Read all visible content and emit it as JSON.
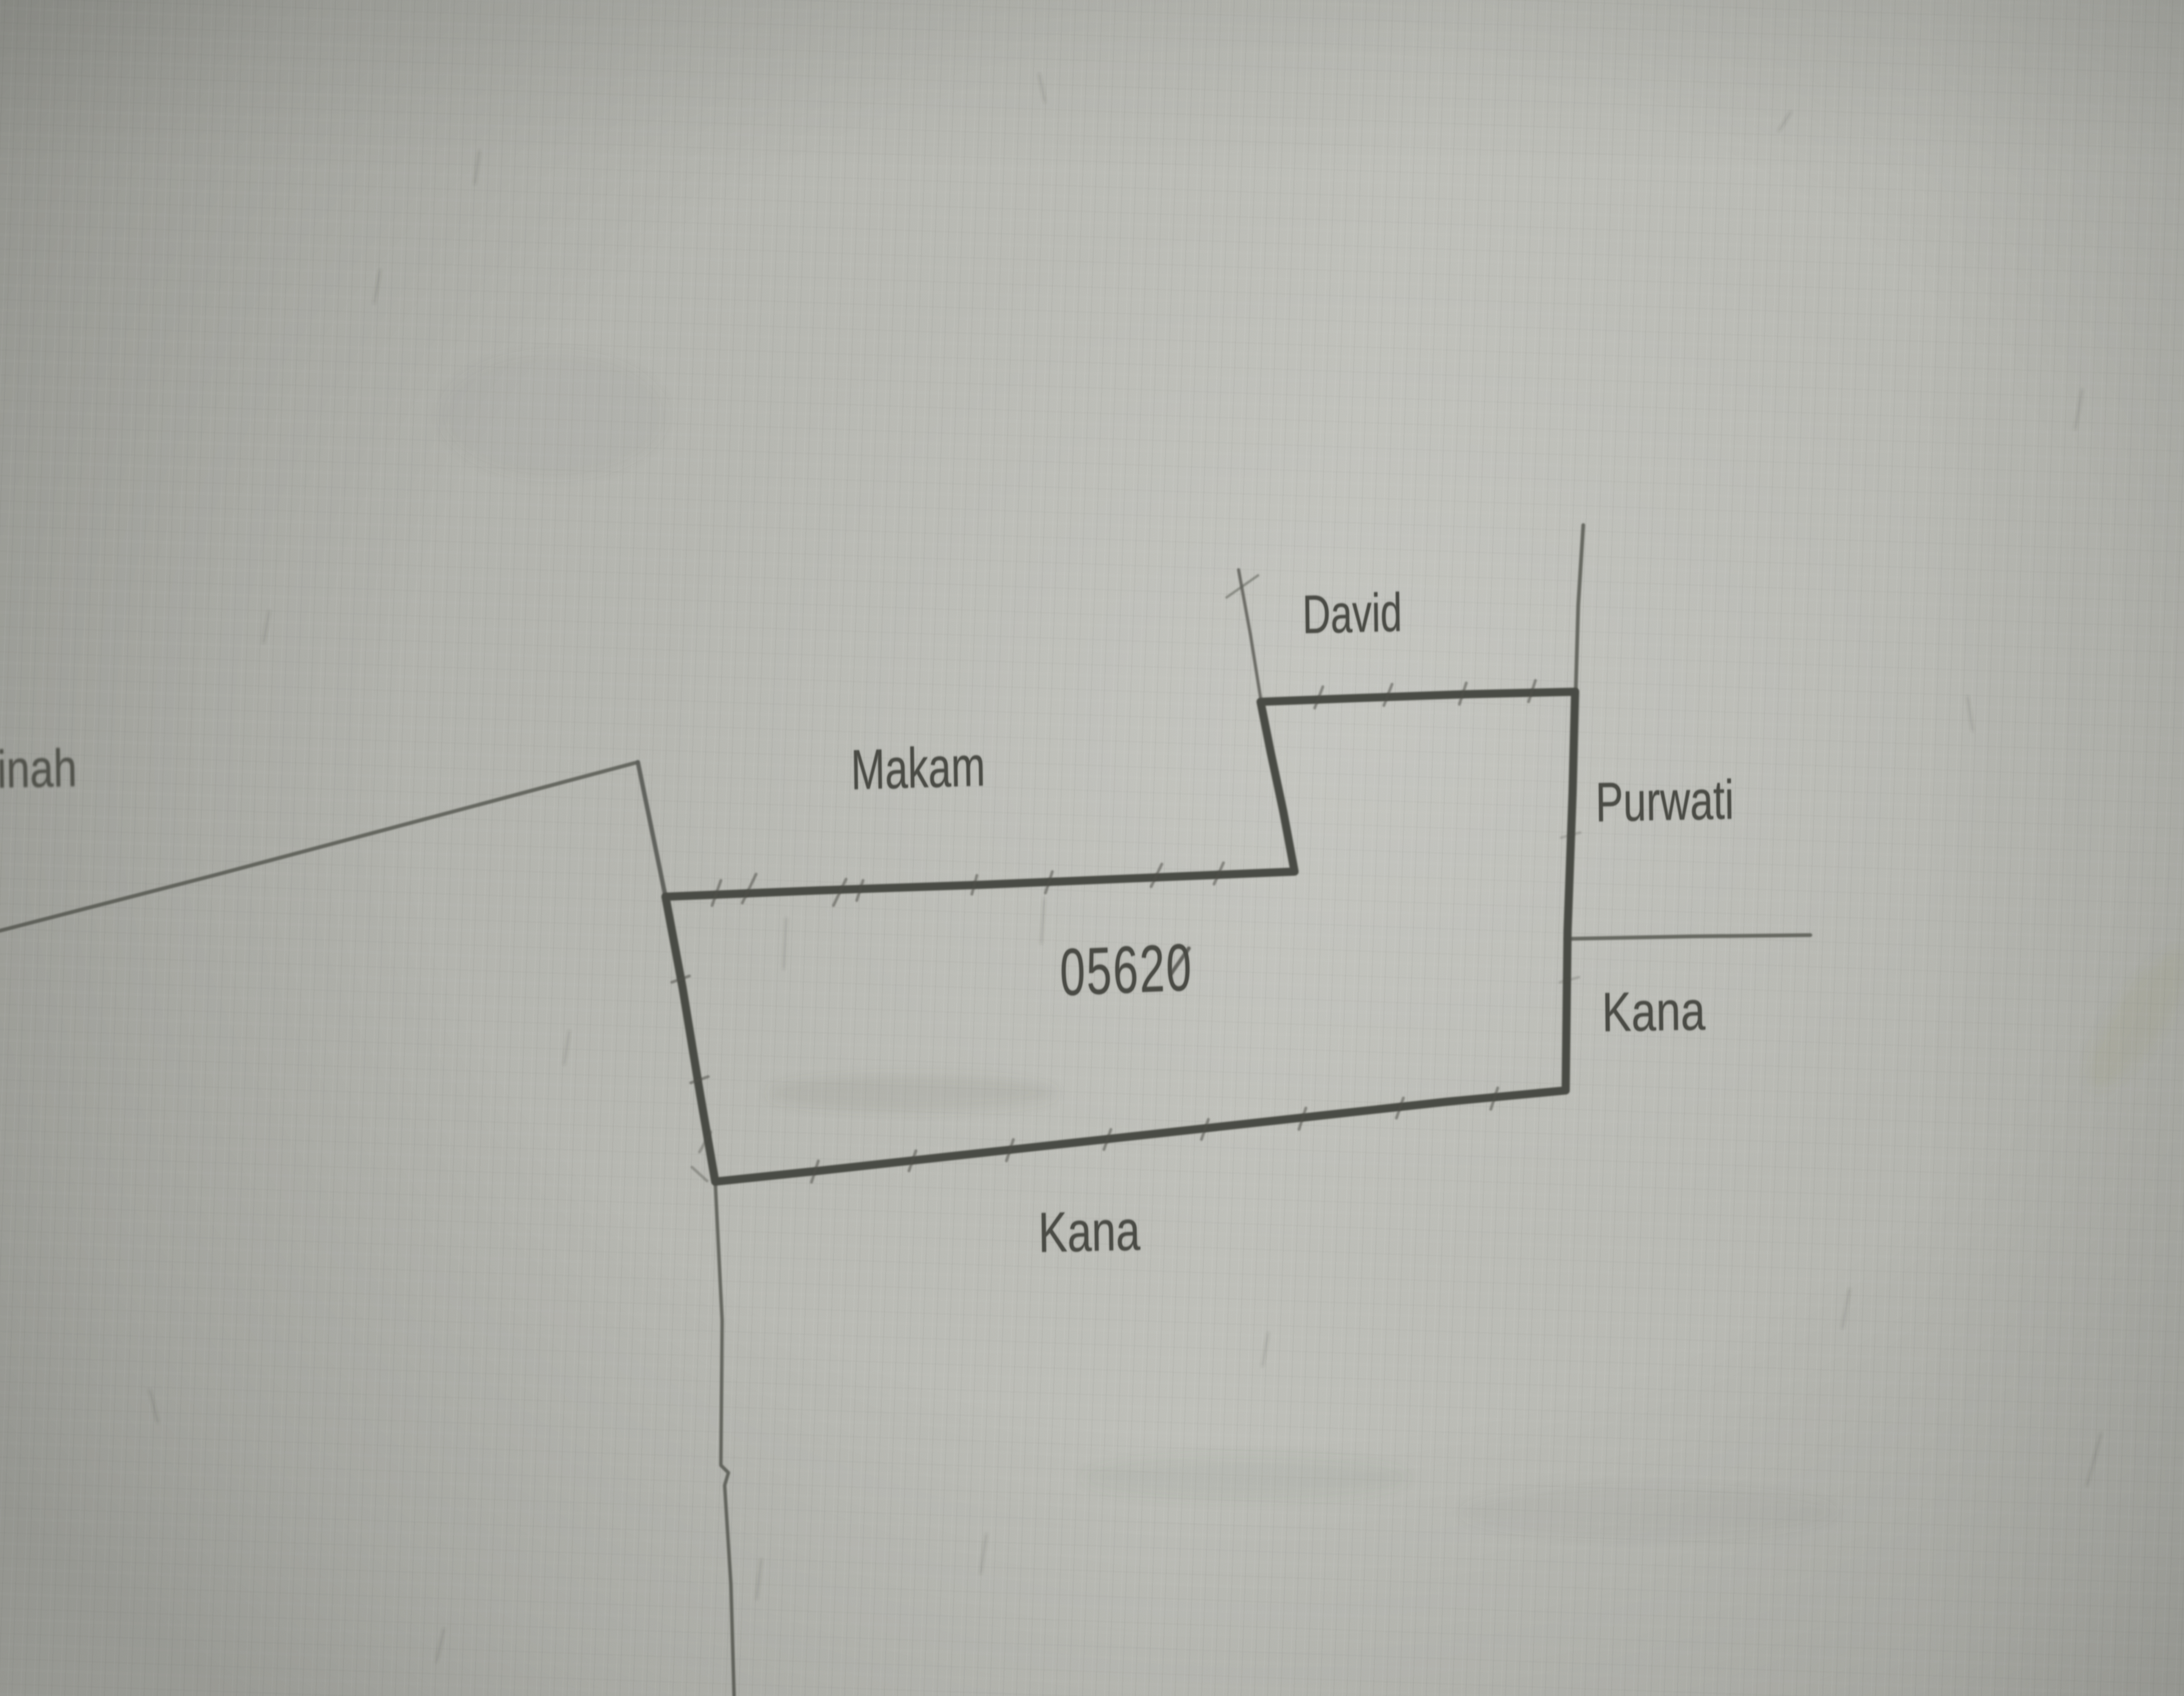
{
  "document": {
    "kind": "scanned cadastral parcel sketch",
    "parcel_number": "05620"
  },
  "labels": {
    "west_partial": "tinah",
    "makam": "Makam",
    "north": "David",
    "east_upper": "Purwati",
    "east_lower": "Kana",
    "south": "Kana"
  },
  "colors": {
    "paper": "#b9bab4",
    "ink_thick": "#4a4b45",
    "ink_thin": "#5d5e58",
    "text": "#4a4b45"
  }
}
